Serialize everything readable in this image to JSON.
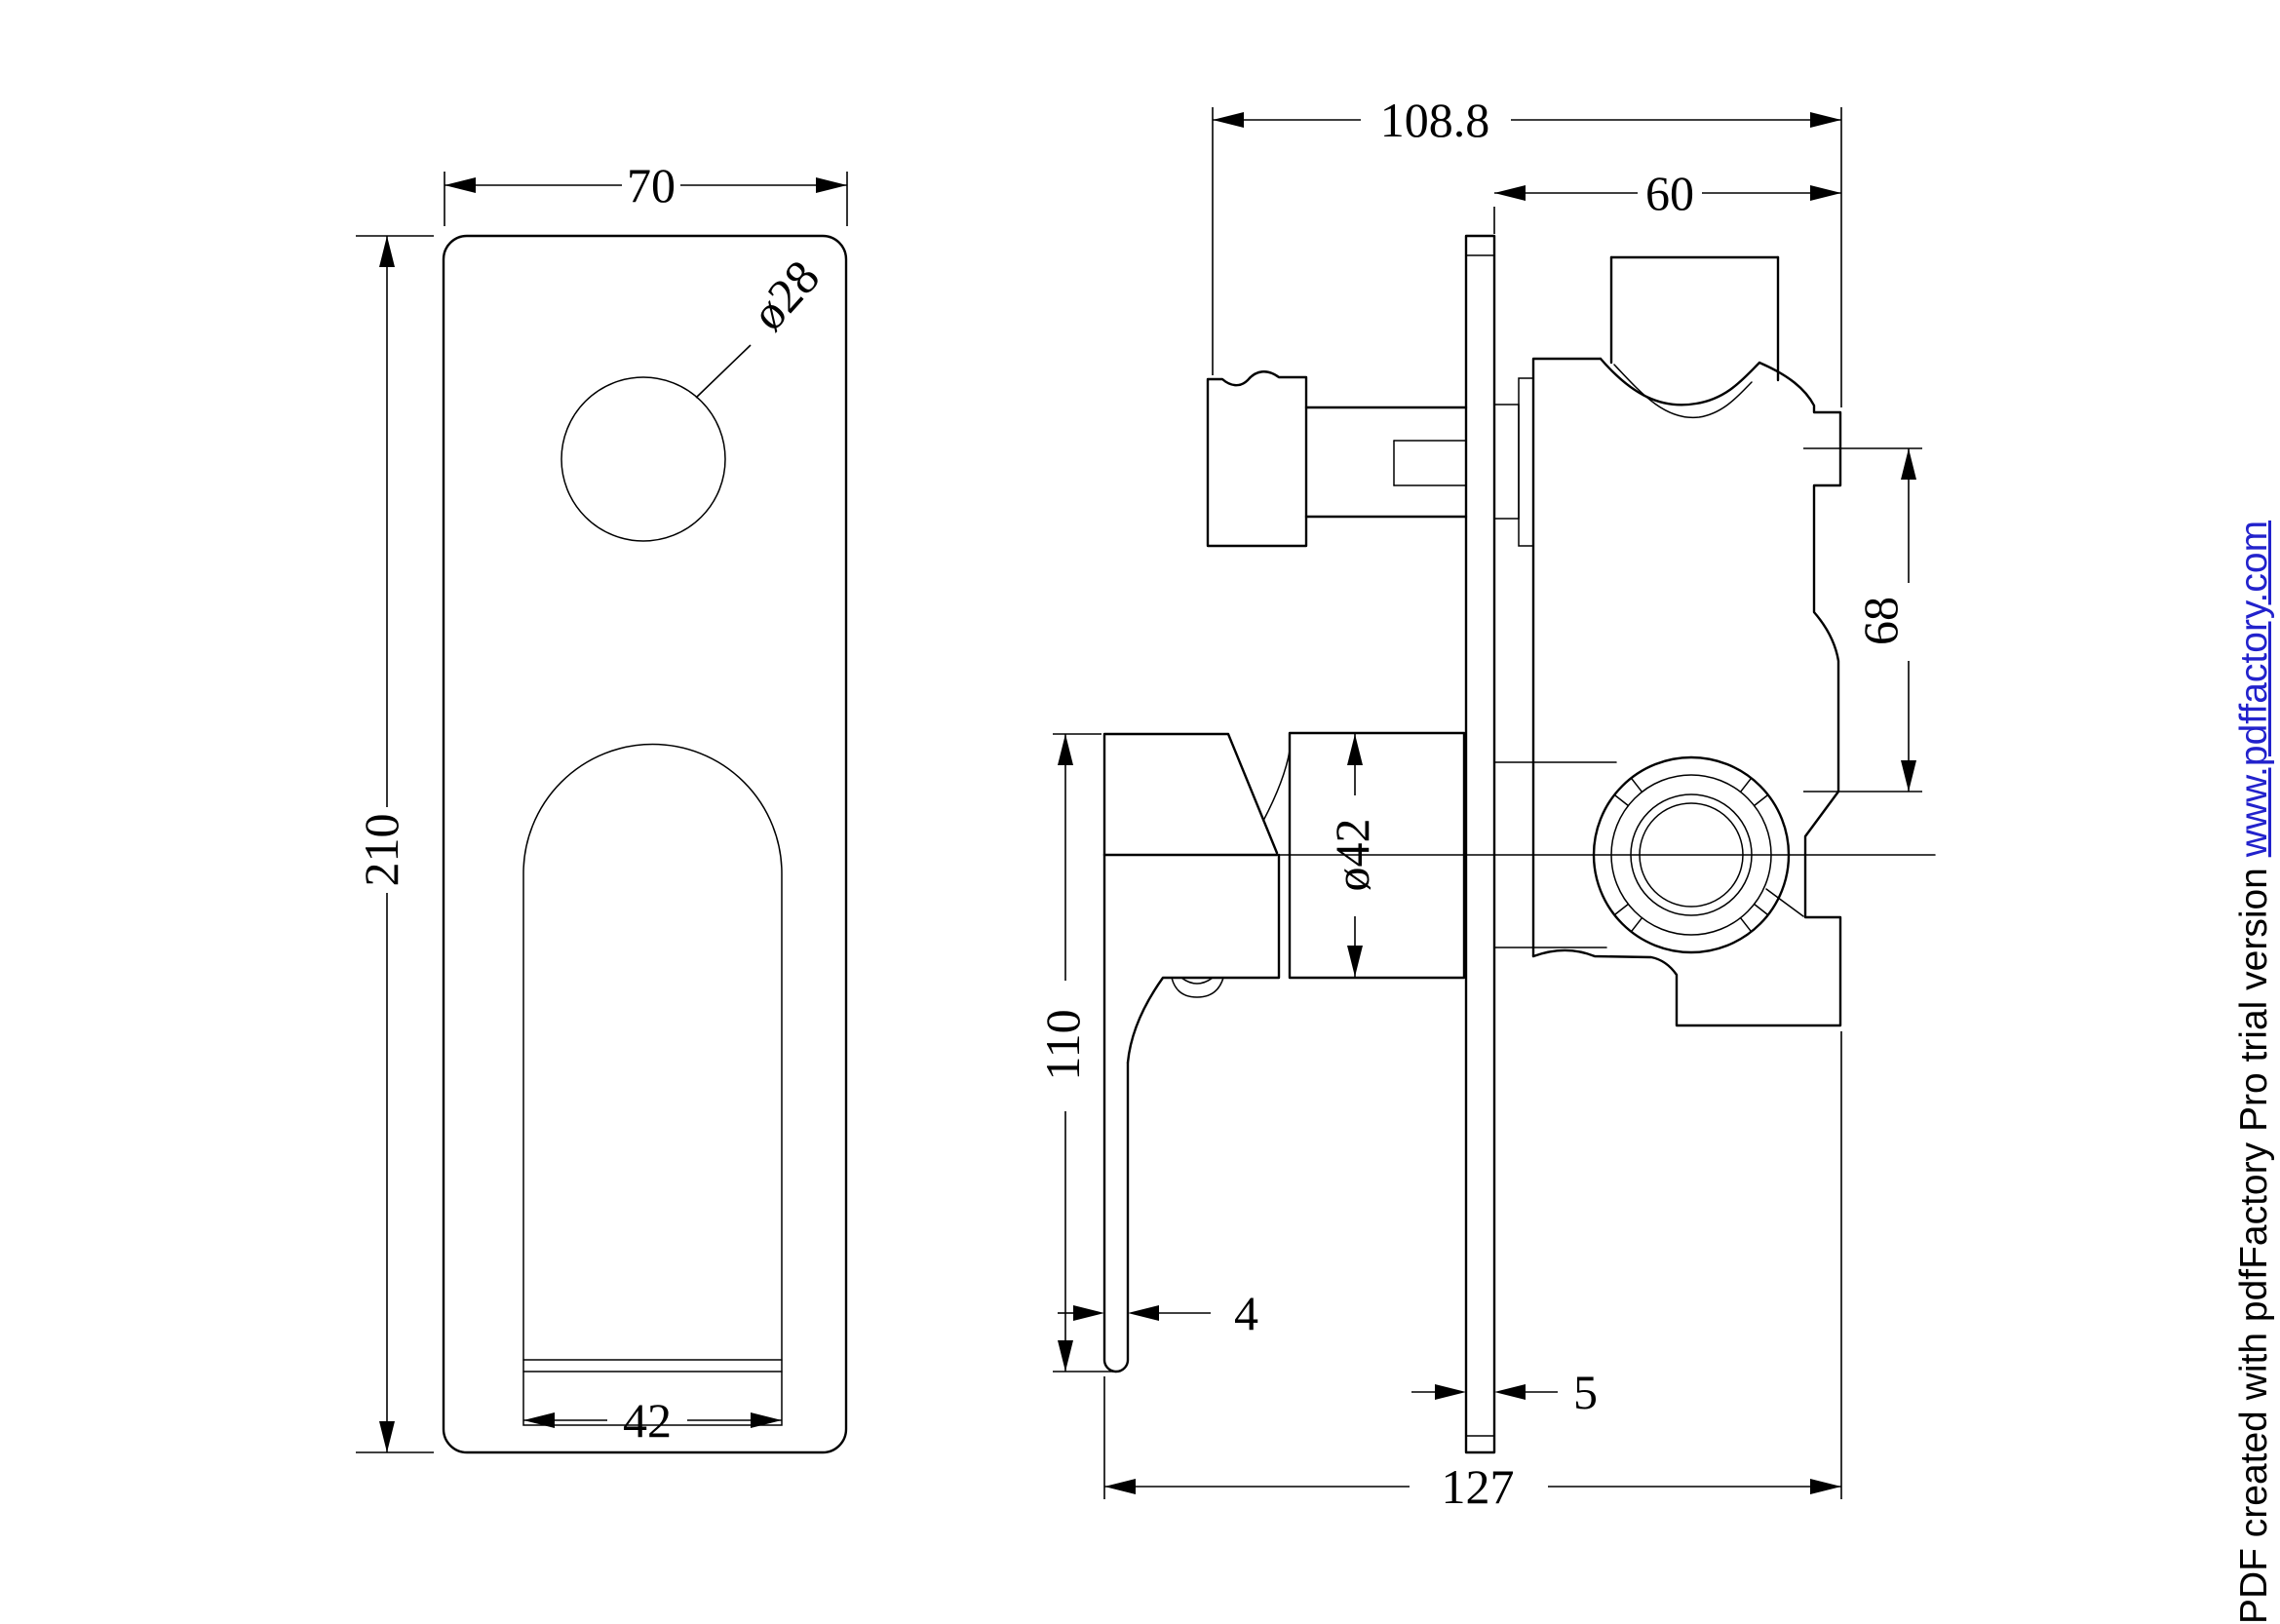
{
  "drawing": {
    "background": "#ffffff",
    "line_color": "#000000",
    "front_view": {
      "plate_width": "70",
      "plate_height": "210",
      "hole_diameter": "ø28",
      "slot_width": "42"
    },
    "side_view": {
      "overall_projection": "108.8",
      "behind_wall_depth": "60",
      "port_offset": "68",
      "trim_sleeve_diameter": "ø42",
      "handle_length": "110",
      "lever_thickness": "4",
      "plate_thickness": "5",
      "total_depth": "127"
    }
  },
  "footer": {
    "text": "PDF created with pdfFactory Pro trial version ",
    "link": "www.pdffactory.com",
    "link_color": "#2222cc"
  }
}
